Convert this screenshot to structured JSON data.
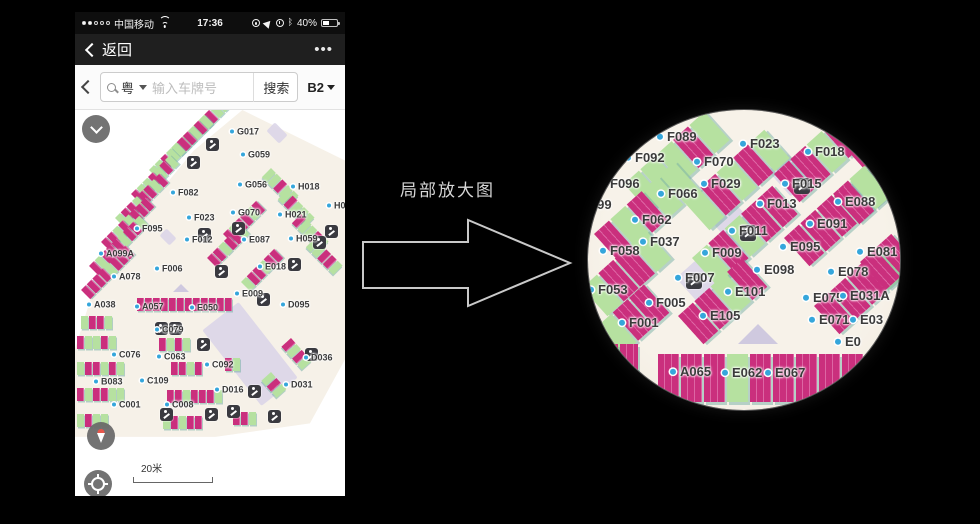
{
  "annotation": {
    "text": "局部放大图"
  },
  "colors": {
    "green": "#b6e1a0",
    "magenta": "#ca2f7d",
    "lavender": "#d9d3e8",
    "beige": "#f6f1e8",
    "label_dot": "#35a6db"
  },
  "phone": {
    "status": {
      "carrier": "中国移动",
      "time": "17:36",
      "battery": "40%",
      "bluetooth": "ᛒ"
    },
    "nav": {
      "back": "返回",
      "more": "•••"
    },
    "search": {
      "region": "粤",
      "placeholder": "输入车牌号",
      "button": "搜索",
      "floor": "B2"
    },
    "controls": {
      "scale": "20米"
    },
    "map": {
      "labels": [
        {
          "t": "G017",
          "x": 155,
          "y": 22
        },
        {
          "t": "G059",
          "x": 166,
          "y": 45
        },
        {
          "t": "G056",
          "x": 163,
          "y": 75
        },
        {
          "t": "H018",
          "x": 216,
          "y": 77
        },
        {
          "t": "F082",
          "x": 96,
          "y": 83
        },
        {
          "t": "G070",
          "x": 156,
          "y": 103
        },
        {
          "t": "H021",
          "x": 203,
          "y": 105
        },
        {
          "t": "H0",
          "x": 252,
          "y": 96
        },
        {
          "t": "F023",
          "x": 112,
          "y": 108
        },
        {
          "t": "F095",
          "x": 60,
          "y": 119
        },
        {
          "t": "F012",
          "x": 110,
          "y": 130
        },
        {
          "t": "E087",
          "x": 167,
          "y": 130
        },
        {
          "t": "H059",
          "x": 214,
          "y": 129
        },
        {
          "t": "A099A",
          "x": 24,
          "y": 144
        },
        {
          "t": "F006",
          "x": 80,
          "y": 159
        },
        {
          "t": "E018",
          "x": 183,
          "y": 157
        },
        {
          "t": "A078",
          "x": 37,
          "y": 167
        },
        {
          "t": "E009",
          "x": 160,
          "y": 184
        },
        {
          "t": "A038",
          "x": 12,
          "y": 195
        },
        {
          "t": "A057",
          "x": 60,
          "y": 197
        },
        {
          "t": "E050",
          "x": 115,
          "y": 198
        },
        {
          "t": "D095",
          "x": 206,
          "y": 195
        },
        {
          "t": "C079",
          "x": 80,
          "y": 220
        },
        {
          "t": "C076",
          "x": 37,
          "y": 245
        },
        {
          "t": "C063",
          "x": 82,
          "y": 247
        },
        {
          "t": "C092",
          "x": 130,
          "y": 255
        },
        {
          "t": "D036",
          "x": 229,
          "y": 248
        },
        {
          "t": "B083",
          "x": 19,
          "y": 272
        },
        {
          "t": "C109",
          "x": 65,
          "y": 271
        },
        {
          "t": "D016",
          "x": 140,
          "y": 280
        },
        {
          "t": "D031",
          "x": 209,
          "y": 275
        },
        {
          "t": "C001",
          "x": 37,
          "y": 295
        },
        {
          "t": "C008",
          "x": 90,
          "y": 295
        }
      ],
      "rows": [
        {
          "x": 118,
          "y": 16,
          "a": -45,
          "cells": "ggmgg"
        },
        {
          "x": 96,
          "y": 38,
          "a": -45,
          "cells": "gmggmg"
        },
        {
          "x": 74,
          "y": 60,
          "a": -45,
          "cells": "ggmggmm"
        },
        {
          "x": 56,
          "y": 84,
          "a": -45,
          "cells": "mggmgmg"
        },
        {
          "x": 40,
          "y": 108,
          "a": -45,
          "cells": "gmmgmmgm"
        },
        {
          "x": 26,
          "y": 132,
          "a": -45,
          "cells": "mmgmgmmm"
        },
        {
          "x": 14,
          "y": 156,
          "a": -45,
          "cells": "mgmmmgmmg"
        },
        {
          "x": 6,
          "y": 180,
          "a": -45,
          "cells": "mmmmgmmm"
        },
        {
          "x": 196,
          "y": 58,
          "a": 45,
          "cells": "ggmgg"
        },
        {
          "x": 212,
          "y": 80,
          "a": 45,
          "cells": "gmggg"
        },
        {
          "x": 226,
          "y": 104,
          "a": 45,
          "cells": "mggmg"
        },
        {
          "x": 240,
          "y": 128,
          "a": 45,
          "cells": "ggmmg"
        },
        {
          "x": 148,
          "y": 124,
          "a": -45,
          "cells": "mgmmgm"
        },
        {
          "x": 132,
          "y": 148,
          "a": -45,
          "cells": "mmgmmg"
        },
        {
          "x": 166,
          "y": 172,
          "a": -45,
          "cells": "gmmgmm"
        },
        {
          "x": 62,
          "y": 188,
          "a": 0,
          "cells": "mmmmmmmmmmmm"
        },
        {
          "x": 6,
          "y": 206,
          "a": 0,
          "cells": "gmmg"
        },
        {
          "x": 2,
          "y": 226,
          "a": 0,
          "cells": "mggmg"
        },
        {
          "x": 84,
          "y": 228,
          "a": 0,
          "cells": "mgmg"
        },
        {
          "x": 2,
          "y": 252,
          "a": 0,
          "cells": "gmmgmg"
        },
        {
          "x": 96,
          "y": 252,
          "a": 0,
          "cells": "mmgm"
        },
        {
          "x": 150,
          "y": 248,
          "a": 0,
          "cells": "mg"
        },
        {
          "x": 216,
          "y": 228,
          "a": 48,
          "cells": "mgmg"
        },
        {
          "x": 2,
          "y": 278,
          "a": 0,
          "cells": "mgmmgg"
        },
        {
          "x": 92,
          "y": 280,
          "a": 0,
          "cells": "mmgmmmg"
        },
        {
          "x": 196,
          "y": 262,
          "a": 48,
          "cells": "gmg"
        },
        {
          "x": 2,
          "y": 304,
          "a": 0,
          "cells": "gmgg"
        },
        {
          "x": 88,
          "y": 306,
          "a": 0,
          "cells": "gmgmm"
        },
        {
          "x": 158,
          "y": 302,
          "a": 0,
          "cells": "mmg"
        }
      ],
      "icons": [
        {
          "x": 131,
          "y": 28
        },
        {
          "x": 112,
          "y": 46
        },
        {
          "x": 123,
          "y": 118
        },
        {
          "x": 157,
          "y": 112
        },
        {
          "x": 250,
          "y": 115
        },
        {
          "x": 238,
          "y": 126
        },
        {
          "x": 213,
          "y": 148
        },
        {
          "x": 140,
          "y": 155
        },
        {
          "x": 182,
          "y": 183
        },
        {
          "x": 80,
          "y": 212
        },
        {
          "x": 94,
          "y": 212
        },
        {
          "x": 122,
          "y": 228
        },
        {
          "x": 230,
          "y": 238
        },
        {
          "x": 173,
          "y": 275
        },
        {
          "x": 85,
          "y": 298
        },
        {
          "x": 130,
          "y": 298
        },
        {
          "x": 152,
          "y": 295
        },
        {
          "x": 193,
          "y": 300
        }
      ],
      "lavender": [
        {
          "x": 152,
          "y": 196,
          "w": 46,
          "h": 96,
          "r": -38
        },
        {
          "x": 196,
          "y": 14,
          "w": 12,
          "h": 18,
          "r": -45
        },
        {
          "x": 88,
          "y": 120,
          "w": 10,
          "h": 14,
          "r": -45
        }
      ],
      "triangles": [
        {
          "x": 98,
          "y": 174,
          "w": 16,
          "h": 8
        }
      ]
    }
  },
  "magnifier": {
    "map": {
      "labels": [
        {
          "t": "F089",
          "x": 69,
          "y": 27
        },
        {
          "t": "F092",
          "x": 37,
          "y": 48
        },
        {
          "t": "F096",
          "x": 12,
          "y": 74
        },
        {
          "t": "F099",
          "x": -16,
          "y": 95
        },
        {
          "t": "F023",
          "x": 152,
          "y": 34
        },
        {
          "t": "F018",
          "x": 217,
          "y": 42
        },
        {
          "t": "F070",
          "x": 106,
          "y": 52
        },
        {
          "t": "F029",
          "x": 113,
          "y": 74
        },
        {
          "t": "F066",
          "x": 70,
          "y": 84
        },
        {
          "t": "F015",
          "x": 194,
          "y": 74
        },
        {
          "t": "F013",
          "x": 169,
          "y": 94
        },
        {
          "t": "E088",
          "x": 247,
          "y": 92
        },
        {
          "t": "F062",
          "x": 44,
          "y": 110
        },
        {
          "t": "E091",
          "x": 219,
          "y": 114
        },
        {
          "t": "F011",
          "x": 141,
          "y": 121
        },
        {
          "t": "F037",
          "x": 52,
          "y": 132
        },
        {
          "t": "F058",
          "x": 12,
          "y": 141
        },
        {
          "t": "F009",
          "x": 114,
          "y": 143
        },
        {
          "t": "E095",
          "x": 192,
          "y": 137
        },
        {
          "t": "E081",
          "x": 269,
          "y": 142
        },
        {
          "t": "E098",
          "x": 166,
          "y": 160
        },
        {
          "t": "E078",
          "x": 240,
          "y": 162
        },
        {
          "t": "F007",
          "x": 87,
          "y": 168
        },
        {
          "t": "F053",
          "x": 0,
          "y": 180
        },
        {
          "t": "E101",
          "x": 137,
          "y": 182
        },
        {
          "t": "E075",
          "x": 215,
          "y": 188
        },
        {
          "t": "E031A",
          "x": 252,
          "y": 186
        },
        {
          "t": "F005",
          "x": 58,
          "y": 193
        },
        {
          "t": "E105",
          "x": 112,
          "y": 206
        },
        {
          "t": "F001",
          "x": 31,
          "y": 213
        },
        {
          "t": "E071",
          "x": 221,
          "y": 210
        },
        {
          "t": "E03",
          "x": 262,
          "y": 210
        },
        {
          "t": "E0",
          "x": 247,
          "y": 232
        },
        {
          "t": "A065",
          "x": 82,
          "y": 262
        },
        {
          "t": "E062",
          "x": 134,
          "y": 263
        },
        {
          "t": "E067",
          "x": 177,
          "y": 263
        }
      ],
      "rows": [
        {
          "x": 36,
          "y": 74,
          "a": -42,
          "cells": "gggmg"
        },
        {
          "x": 6,
          "y": 124,
          "a": -42,
          "cells": "mgmgg"
        },
        {
          "x": -6,
          "y": 178,
          "a": -42,
          "cells": "gmmg"
        },
        {
          "x": -8,
          "y": 232,
          "a": -42,
          "cells": "mgmm"
        },
        {
          "x": 96,
          "y": 92,
          "a": -42,
          "cells": "gmgmg"
        },
        {
          "x": 104,
          "y": 148,
          "a": -42,
          "cells": "gmgmm"
        },
        {
          "x": 90,
          "y": 206,
          "a": -42,
          "cells": "mmgm"
        },
        {
          "x": 186,
          "y": 64,
          "a": -42,
          "cells": "mmgm"
        },
        {
          "x": 250,
          "y": 30,
          "a": -42,
          "cells": "mg"
        },
        {
          "x": 196,
          "y": 128,
          "a": -42,
          "cells": "mmmmg"
        },
        {
          "x": 246,
          "y": 86,
          "a": -42,
          "cells": "mgmm"
        },
        {
          "x": 226,
          "y": 196,
          "a": -42,
          "cells": "mmmg"
        },
        {
          "x": 272,
          "y": 152,
          "a": -42,
          "cells": "mm"
        },
        {
          "x": 12,
          "y": 234,
          "a": 0,
          "cells": "mm",
          "cw": 18,
          "ch": 26
        },
        {
          "x": 70,
          "y": 244,
          "a": 0,
          "cells": "mmmgmmmmmm",
          "cw": 21,
          "ch": 48
        }
      ],
      "icons": [
        {
          "x": 206,
          "y": 68
        },
        {
          "x": 152,
          "y": 115
        },
        {
          "x": 98,
          "y": 163
        }
      ],
      "lavender": [
        {
          "x": 188,
          "y": 48,
          "w": 26,
          "h": 34,
          "r": -42
        },
        {
          "x": 136,
          "y": 100,
          "w": 30,
          "h": 40,
          "r": -42
        },
        {
          "x": 96,
          "y": 155,
          "w": 26,
          "h": 34,
          "r": -42
        }
      ],
      "triangles": [
        {
          "x": 150,
          "y": 214,
          "w": 40,
          "h": 20
        }
      ]
    }
  }
}
